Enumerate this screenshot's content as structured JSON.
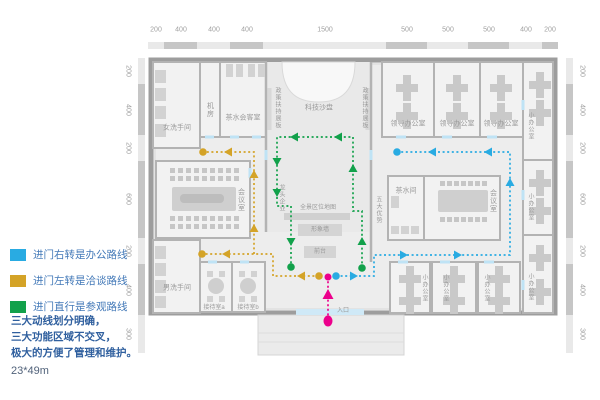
{
  "legend": {
    "items": [
      {
        "id": "office-route",
        "label": "进门右转是办公路线",
        "color": "#29abe2"
      },
      {
        "id": "negotiation-route",
        "label": "进门左转是洽谈路线",
        "color": "#d4a327"
      },
      {
        "id": "visit-route",
        "label": "进门直行是参观路线",
        "color": "#12a14b"
      }
    ],
    "notes": [
      "三大动线划分明确，",
      "三大功能区域不交叉，",
      "极大的方便了管理和维护。"
    ],
    "size": "23*49m"
  },
  "dimensions": {
    "top": [
      "200",
      "400",
      "400",
      "400",
      "1500",
      "500",
      "500",
      "500",
      "400",
      "200"
    ],
    "left": [
      "200",
      "400",
      "200",
      "600",
      "200",
      "400",
      "300"
    ],
    "right": [
      "200",
      "400",
      "200",
      "600",
      "200",
      "400",
      "300"
    ]
  },
  "rooms": {
    "women_restroom": "女洗手间",
    "machine_room": "机房",
    "tea_meeting_room": "茶水会客室",
    "tech_sand_table": "科技沙盘",
    "policy_board": "政策扶持展板",
    "leader_office": "领导办公室",
    "small_office": "小办公室",
    "meeting_room": "会议室",
    "leading_enterprise": "龙头企业",
    "five_advantages": "五大优势",
    "tea_room": "茶水间",
    "men_restroom": "男洗手间",
    "reception_a": "接待室a",
    "reception_b": "接待室b",
    "area_map": "全景区位地图",
    "image_wall": "形象墙",
    "front_desk": "前台",
    "entrance": "入口"
  },
  "routes": {
    "office": "#29abe2",
    "negotiation": "#d4a327",
    "visit": "#12a14b",
    "entry": "#ec008c"
  }
}
